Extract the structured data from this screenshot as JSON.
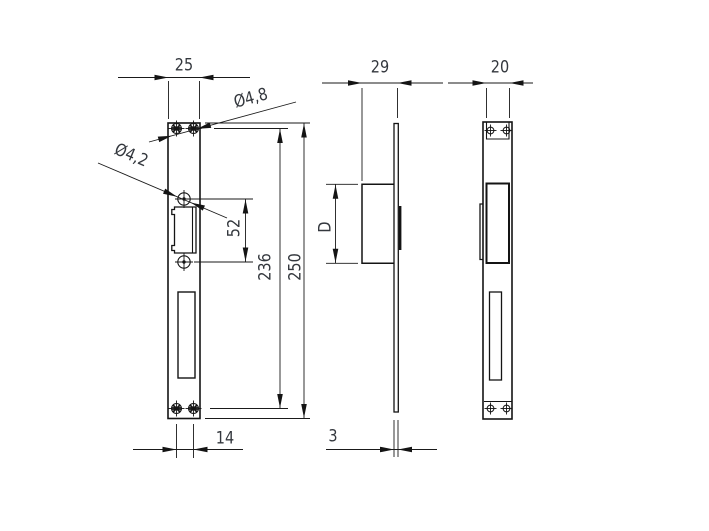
{
  "page": {
    "background": "#ffffff",
    "line_color": "#141414",
    "dim_line_color": "#1a1a1a",
    "text_color": "#34383e"
  },
  "drawing": {
    "kind": "technical-drawing",
    "subject": "electric strike / lock faceplate, three orthographic views",
    "views": [
      {
        "id": "front-view",
        "name": "front view of faceplate"
      },
      {
        "id": "side-view",
        "name": "side profile with strike box"
      },
      {
        "id": "back-view",
        "name": "rear view of faceplate"
      }
    ],
    "labels": {
      "width_front": "25",
      "dia_top_holes": "Ø4,8",
      "dia_mid_holes": "Ø4,2",
      "cutout_height": "52",
      "hole_span_height": "236",
      "total_height": "250",
      "bottom_hole_spacing": "14",
      "side_depth": "29",
      "keeper_height": "D",
      "plate_thickness": "3",
      "back_width": "20"
    }
  }
}
